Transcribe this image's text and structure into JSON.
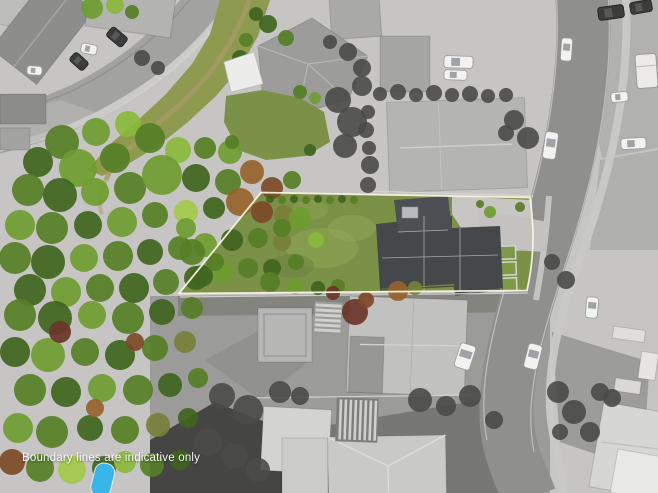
{
  "image": {
    "kind": "aerial-property-photo",
    "disclaimer": "Boundary lines are indicative only"
  },
  "palette": {
    "boundary_line": "#f7f2e0",
    "text_white": "#ffffff",
    "pool_blue": "#38b6e9",
    "lawn_green": "#7c9148",
    "reserve_green": "#8e9a50",
    "forest_greens": [
      "#2e4a1c",
      "#3f651f",
      "#567f27",
      "#6f9c30",
      "#8ab83c",
      "#a3c94a",
      "#76803a"
    ],
    "autumn_rust": "#96622e",
    "autumn_auburn": "#7c4a28",
    "autumn_red": "#6b3528",
    "road_gray": "#8f8f8d",
    "paving_gray": "#c6c5c3",
    "dark_roof_gray": "#45484b",
    "light_roof_gray": "#c1c1bf",
    "car_white": "#f2f2f0",
    "car_dark": "#3c3c3a",
    "shade_sail_white": "#ececea",
    "gray_tree": "#4a4a48",
    "dirt_path_tan": "#a79a64"
  }
}
